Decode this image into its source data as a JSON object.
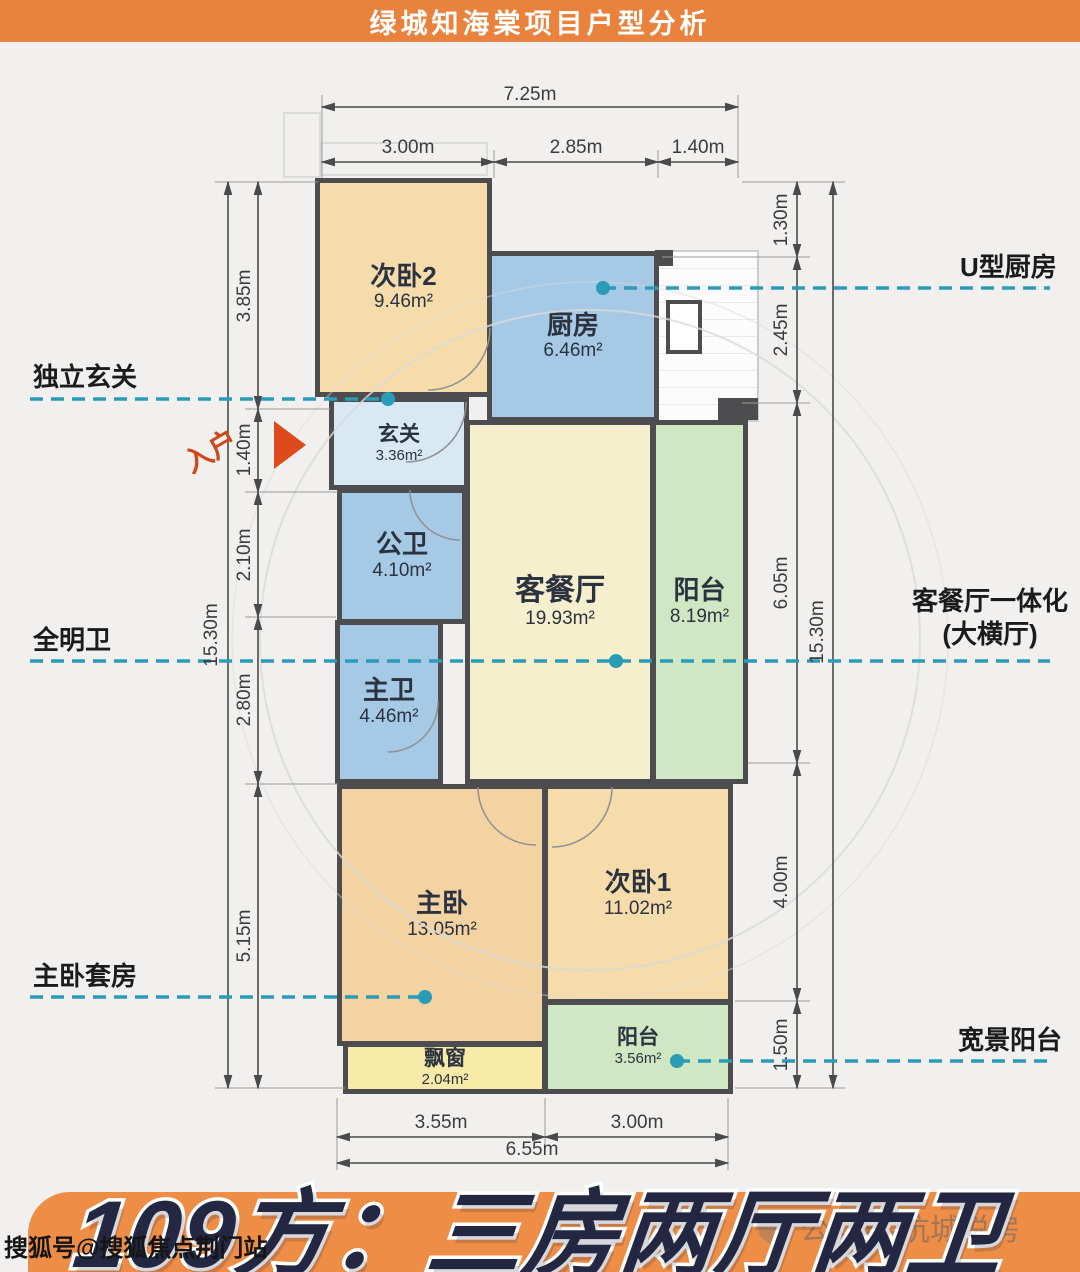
{
  "header": {
    "title": "绿城知海棠项目户型分析"
  },
  "rooms": [
    {
      "name": "次卧2",
      "area": "9.46m²"
    },
    {
      "name": "厨房",
      "area": "6.46m²"
    },
    {
      "name": "玄关",
      "area": "3.36m²"
    },
    {
      "name": "公卫",
      "area": "4.10m²"
    },
    {
      "name": "客餐厅",
      "area": "19.93m²"
    },
    {
      "name": "阳台",
      "area": "8.19m²"
    },
    {
      "name": "主卫",
      "area": "4.46m²"
    },
    {
      "name": "走道",
      "area": "1.44m²"
    },
    {
      "name": "主卧",
      "area": "13.05m²"
    },
    {
      "name": "次卧1",
      "area": "11.02m²"
    },
    {
      "name": "阳台",
      "area": "3.56m²"
    },
    {
      "name": "飘窗",
      "area": "2.04m²"
    }
  ],
  "dimensions": {
    "top_total": "7.25m",
    "top_1": "3.00m",
    "top_2": "2.85m",
    "top_3": "1.40m",
    "left_total": "15.30m",
    "left_1": "3.85m",
    "left_2": "1.40m",
    "left_3": "2.10m",
    "left_4": "2.80m",
    "left_5": "5.15m",
    "right_1": "1.30m",
    "right_2": "2.45m",
    "right_3": "6.05m",
    "right_total": "15.30m",
    "right_4": "4.00m",
    "right_5": "1.50m",
    "bottom_1": "3.55m",
    "bottom_2": "3.00m",
    "bottom_total": "6.55m"
  },
  "callouts": {
    "entry_foyer": "独立玄关",
    "entry_arrow": "入户",
    "bright_bath": "全明卫",
    "master_suite": "主卧套房",
    "u_kitchen": "U型厨房",
    "integrated_living_1": "客餐厅一体化",
    "integrated_living_2": "(大横厅)",
    "wide_balcony": "宽景阳台"
  },
  "footer": {
    "title": "109方：三房两厅两卫"
  },
  "watermarks": {
    "bottom_left": "搜狐号@搜狐焦点荆门站",
    "bottom_right": "公众号-杭城说房"
  },
  "colors": {
    "header_orange": "#E8823C",
    "footer_orange": "#EE8D45",
    "wall_gray": "#4D4D4F",
    "callout_teal": "#2A9CB8",
    "bedroom_tan": "#F6DCAB",
    "kitchen_blue": "#A6C9E6",
    "living_yellow": "#F6EFCD",
    "balcony_green": "#CFE7C2",
    "foyer_blue": "#D9E9F3",
    "bay_window_yellow": "#F8EAA9",
    "entry_red": "#DD4A1C",
    "title_navy": "#232741"
  }
}
